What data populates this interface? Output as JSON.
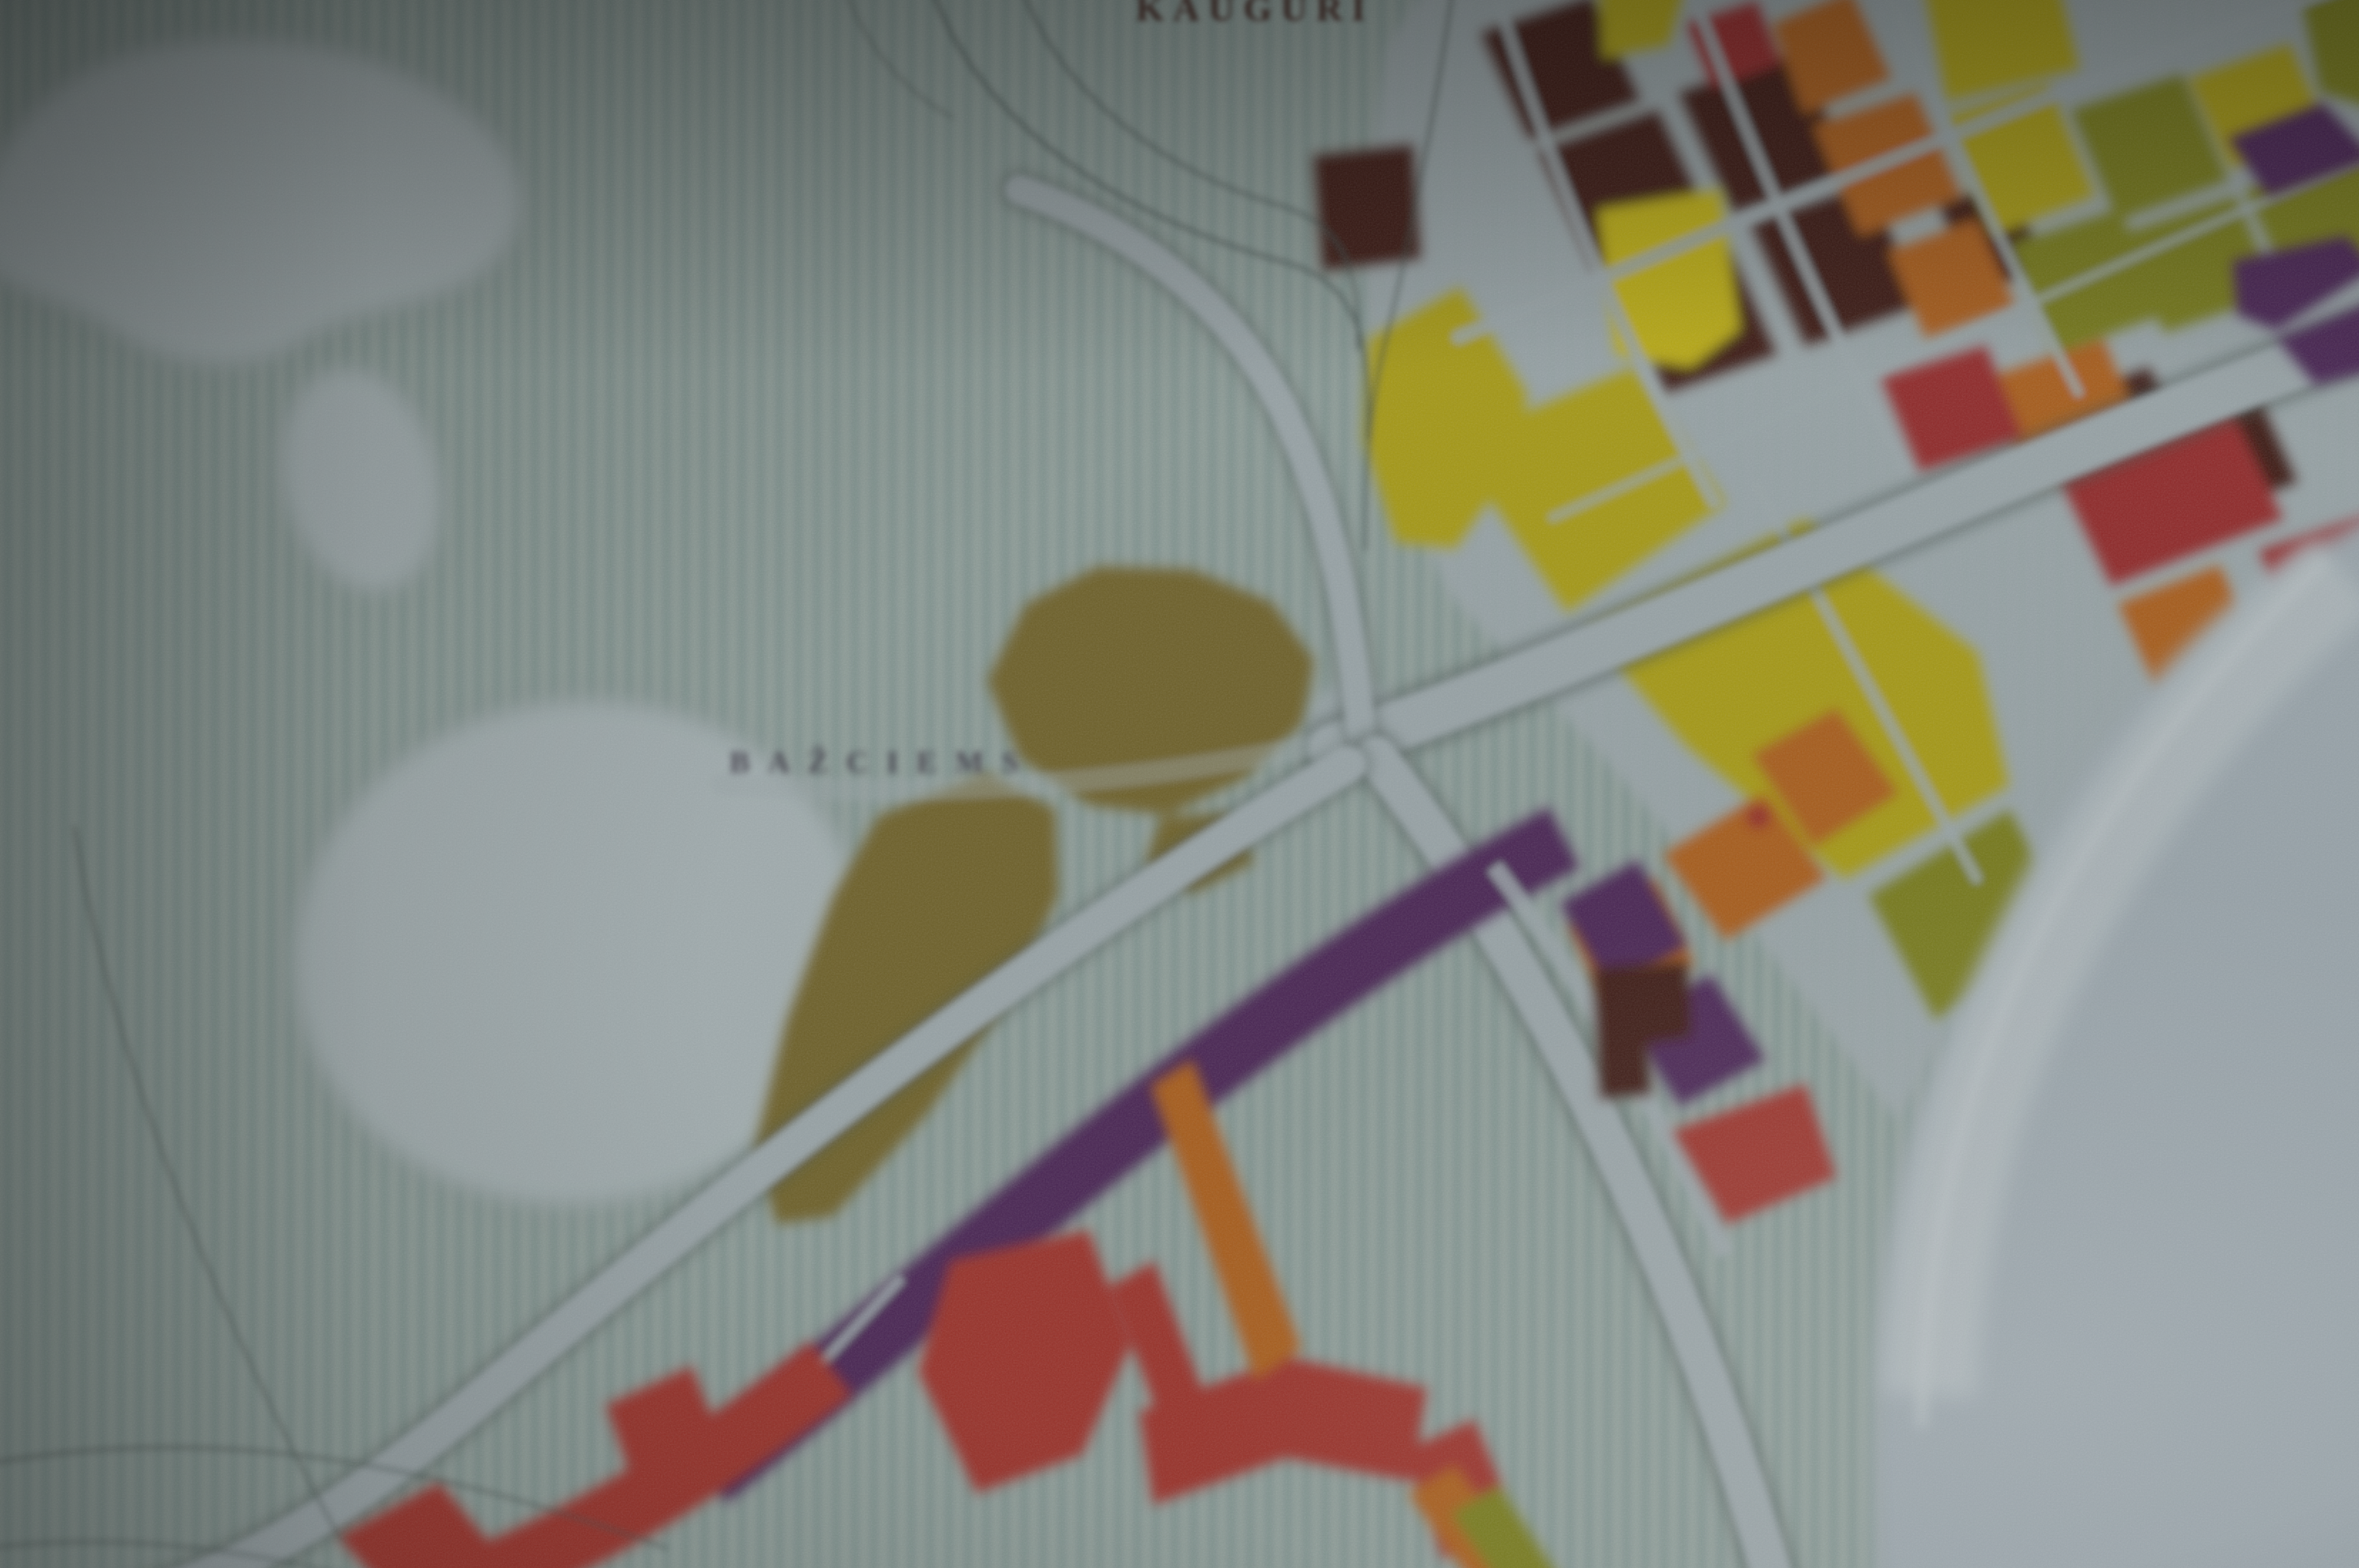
{
  "map": {
    "labels": {
      "kauguri": "KAUGURI",
      "bazciems": "BAŽCIEMS"
    },
    "palette": {
      "background": "#8e9b97",
      "stripe": "#67817b",
      "lake": "#9faaac",
      "lake_edge": "#64736f",
      "water": "#96a1a7",
      "water_highlight": "#a9b2b6",
      "road": "#96a1a4",
      "road_edge": "#47534f",
      "line": "#3f4c49",
      "yellow": "#a39714",
      "yellow_bright": "#b7a913",
      "olive_green": "#74781b",
      "khaki": "#6d6129",
      "orange": "#a55c1d",
      "maroon": "#3c1d15",
      "crimson": "#8e2a2c",
      "red": "#97322a",
      "purple": "#4a2752",
      "label_dark": "#432b26",
      "label_gray": "#3f3a46"
    }
  }
}
